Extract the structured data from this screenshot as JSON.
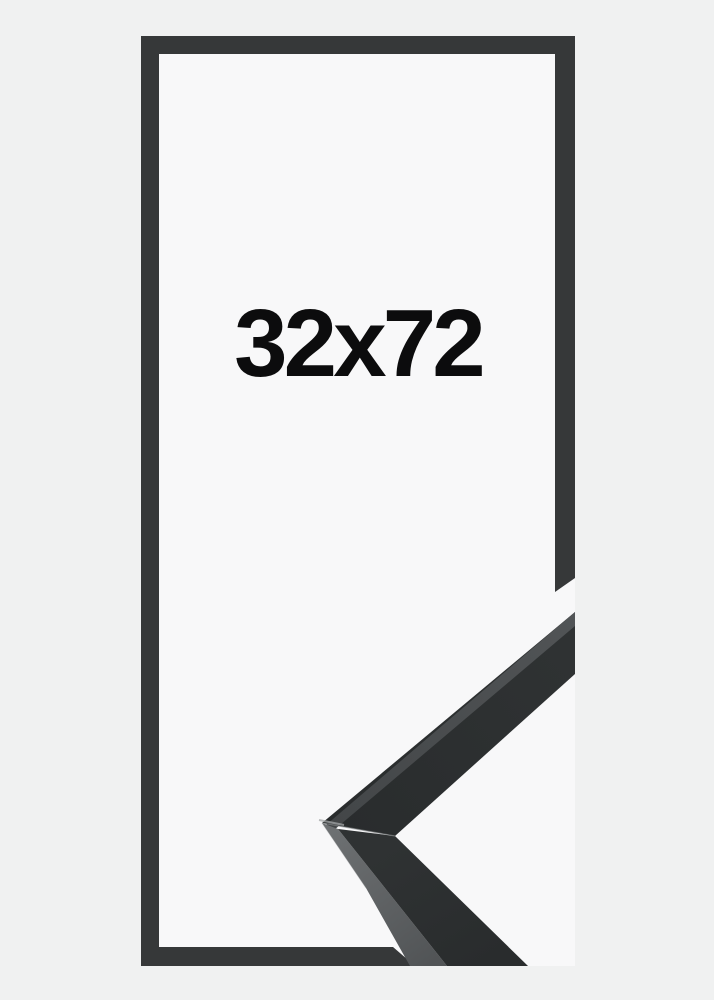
{
  "product": {
    "size_label": "32x72"
  },
  "colors": {
    "background": "#f0f1f1",
    "interior": "#f8f8f9",
    "outline": "#363839",
    "sample_front": "#2f3233",
    "sample_front_dark": "#292c2d",
    "sample_front_light": "#434648",
    "sample_side": "#515456",
    "sample_side_light": "#6e7173",
    "seam": "#8b8e90",
    "corner_highlight": "#a4a7a8",
    "text": "#0c0c0d"
  }
}
